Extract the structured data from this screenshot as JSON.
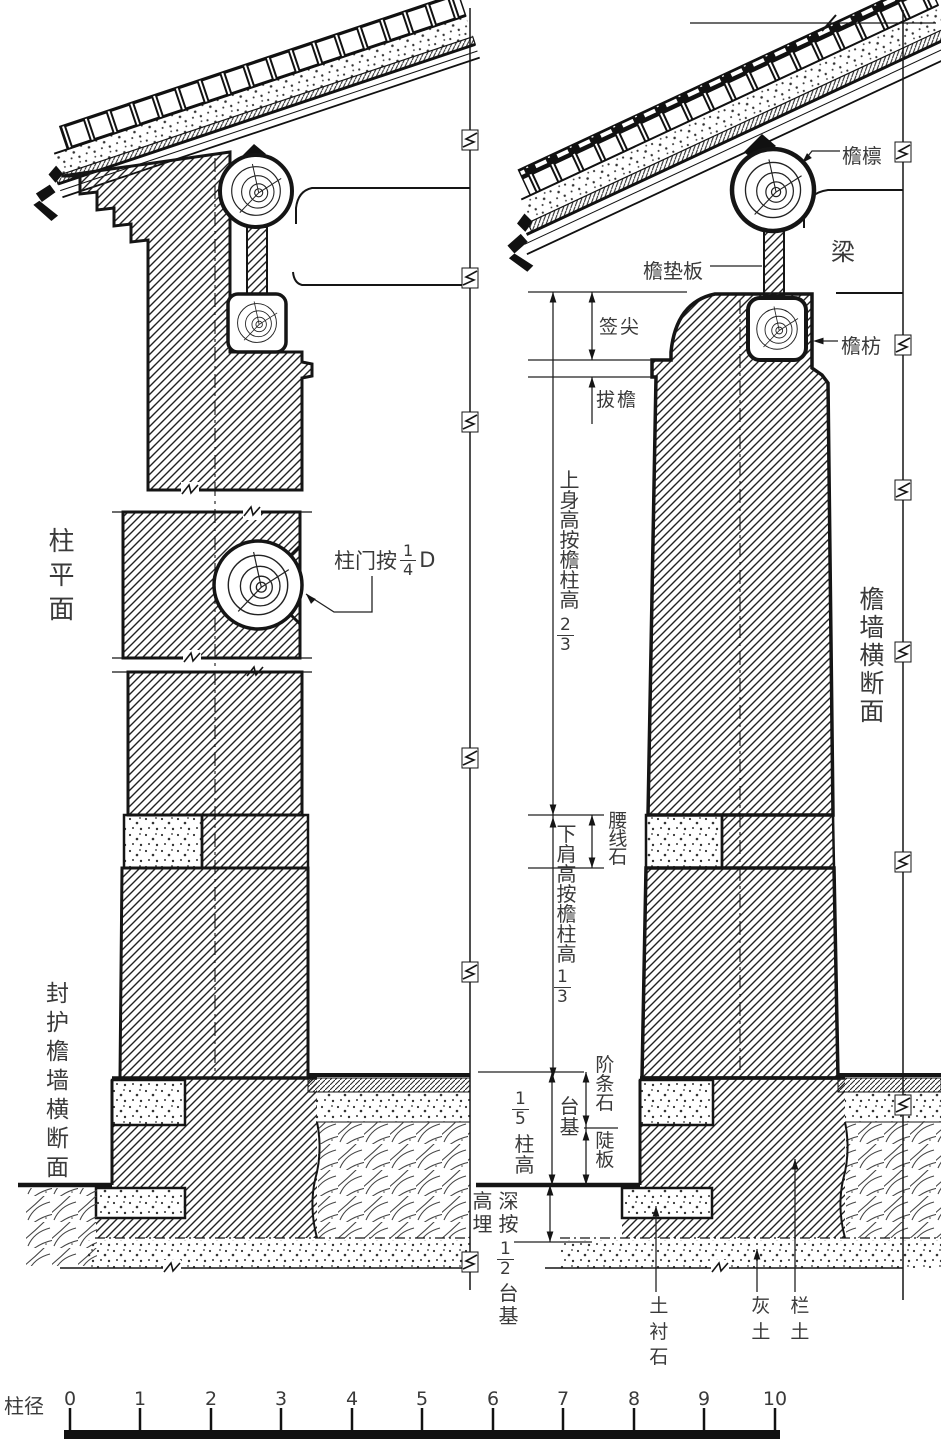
{
  "labels": {
    "zhu_pingmian": "柱平面",
    "zhumen": {
      "prefix": "柱门按",
      "frac": {
        "num": "1",
        "den": "4"
      },
      "suffix": "D"
    },
    "fenghu_yanqiang": "封护檐墙横断面",
    "qianjian": "签尖",
    "bayan": "拔檐",
    "shangshen": {
      "text": "上身高按檐柱高",
      "frac": {
        "num": "2",
        "den": "3"
      }
    },
    "yaoxianshi": "腰线石",
    "xiajian": {
      "text": "下肩高按檐柱高",
      "frac": {
        "num": "1",
        "den": "3"
      }
    },
    "jietiaoshi": "阶条石",
    "douban": "陡板",
    "taiji": "台基",
    "wufen_zhugao": {
      "frac": {
        "num": "1",
        "den": "5"
      },
      "text": "柱高"
    },
    "maishen": {
      "col_left": "高埋",
      "col_right": "深按",
      "frac": {
        "num": "1",
        "den": "2"
      },
      "text": "台基"
    },
    "yanlin": "檐檩",
    "liang": "梁",
    "yandianban": "檐垫板",
    "yanfang": "檐枋",
    "yanqiang_duanmian": "檐墙横断面",
    "tuchenshi": "土衬石",
    "huitu": "灰土",
    "lantu": "栏土"
  },
  "scale": {
    "label": "柱径",
    "ticks": [
      "0",
      "1",
      "2",
      "3",
      "4",
      "5",
      "6",
      "7",
      "8",
      "9",
      "10"
    ]
  },
  "colors": {
    "ink": "#151515",
    "label": "#3a3a3a",
    "paper": "#ffffff"
  }
}
